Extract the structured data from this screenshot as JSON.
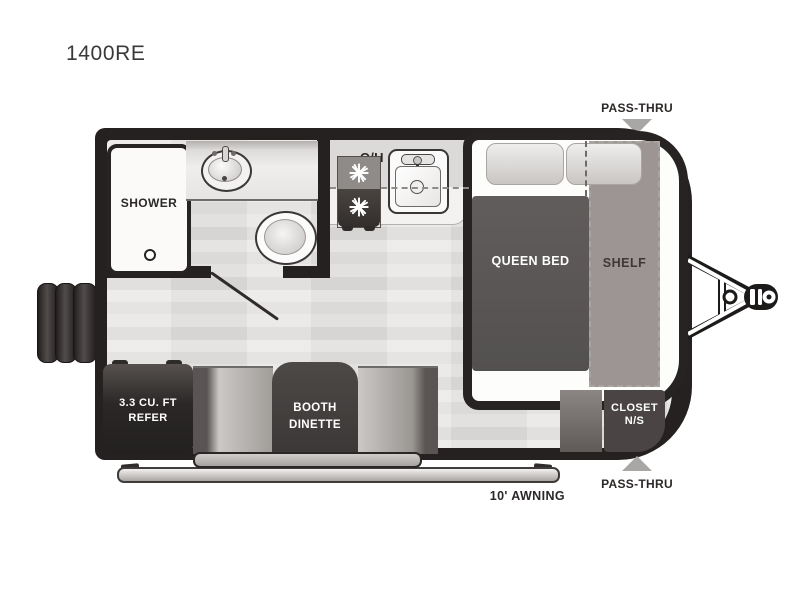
{
  "page": {
    "title": "1400RE"
  },
  "floorplan": {
    "pass_thru_top": "PASS-THRU",
    "pass_thru_bottom": "PASS-THRU",
    "awning": "10' AWNING",
    "bathroom": {
      "shower": "SHOWER"
    },
    "kitchen": {
      "overhead": "O/H"
    },
    "bedroom": {
      "queen_bed": "QUEEN BED",
      "shelf": "SHELF",
      "closet": [
        "CLOSET",
        "N/S"
      ]
    },
    "dinette": [
      "BOOTH",
      "DINETTE"
    ],
    "refer": [
      "3.3 CU. FT",
      "REFER"
    ]
  },
  "icons": {
    "pass_thru_arrow": "filled-triangle",
    "stove_burner": "white-starburst",
    "shower_drain": "small-circle",
    "bathroom_sink": "oval-basin-with-faucet",
    "kitchen_sink": "square-basin-with-faucet",
    "toilet": "round-bowl",
    "tow_hitch": "a-frame-with-coupler",
    "entry_steps": "three-vertical-bars"
  },
  "colors": {
    "wall_black": "#242120",
    "floor_light": "#e7e5e3",
    "bed_charcoal": "#5a5655",
    "shelf_gray": "#9c9593",
    "bench_gray": "#b3b0ad",
    "table_charcoal": "#3b3837",
    "label_ink": "#2b2827",
    "arrow_gray": "#a9a7a5",
    "paper_white": "#ffffff"
  }
}
